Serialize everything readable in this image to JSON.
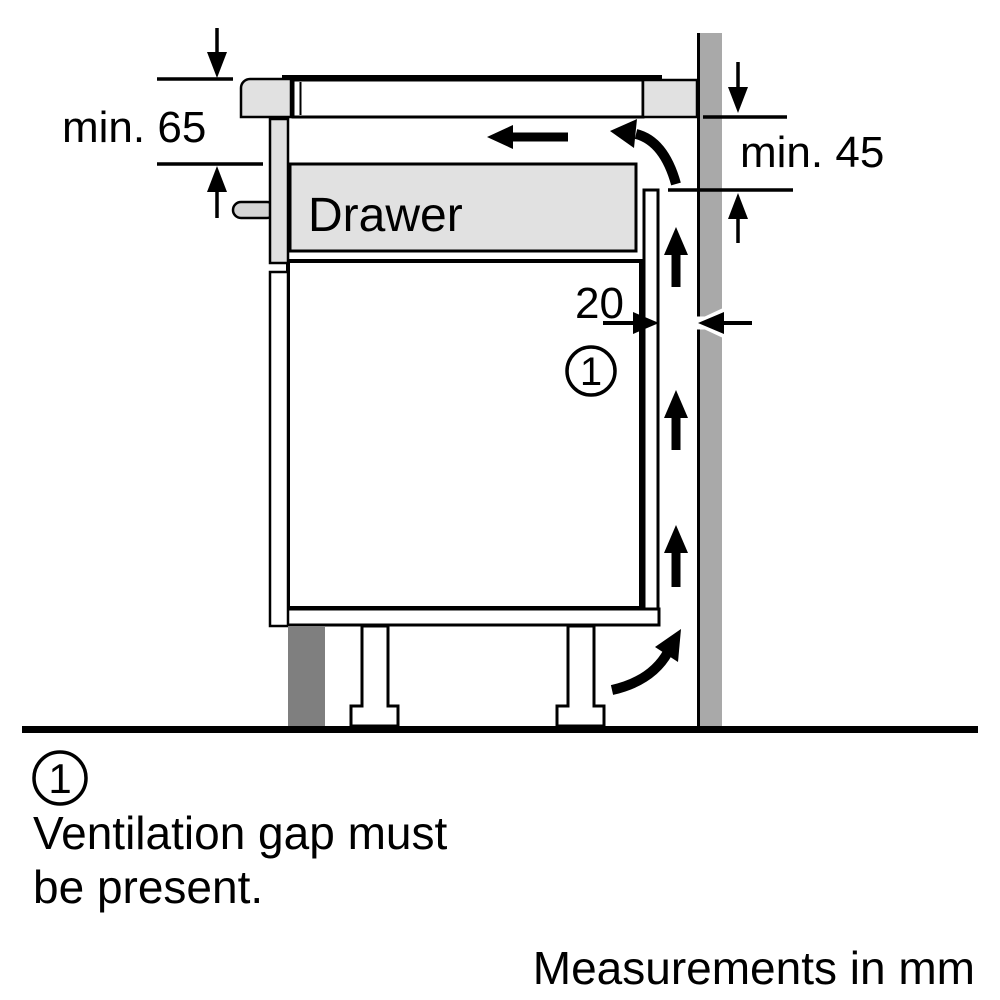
{
  "diagram": {
    "drawer_label": "Drawer",
    "dimensions": {
      "hob_clearance": "min. 65",
      "rear_clearance": "min. 45",
      "ventilation_gap": "20"
    },
    "callout": {
      "number": "1"
    },
    "colors": {
      "background": "#ffffff",
      "line": "#000000",
      "panel_light": "#e1e1e1",
      "handle": "#d4d4d4",
      "wall": "#a9a9a9",
      "plinth": "#7f7f7f"
    }
  },
  "footnote": {
    "number": "1",
    "line1": "Ventilation gap must",
    "line2": "be present."
  },
  "units_note": "Measurements in mm"
}
